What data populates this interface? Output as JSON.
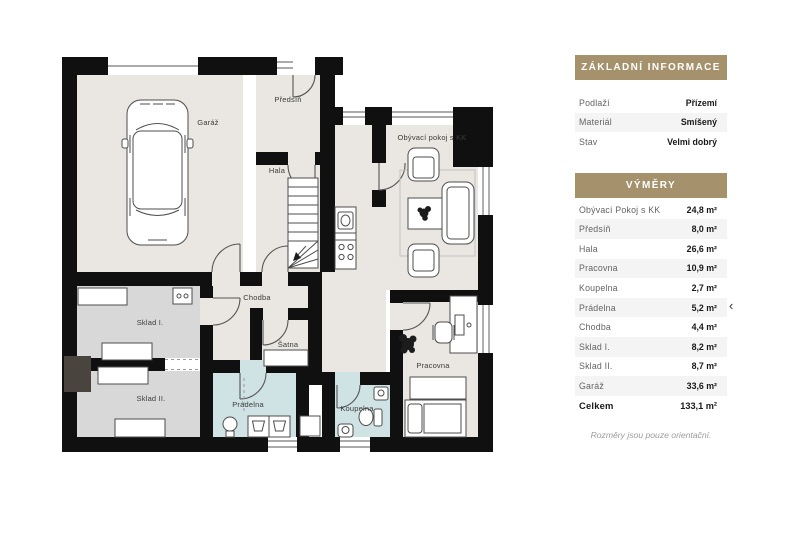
{
  "panel": {
    "basic_info": {
      "title": "ZÁKLADNÍ INFORMACE",
      "rows": [
        {
          "label": "Podlaží",
          "value": "Přízemí"
        },
        {
          "label": "Materiál",
          "value": "Smíšený"
        },
        {
          "label": "Stav",
          "value": "Velmi dobrý"
        }
      ]
    },
    "dimensions": {
      "title": "VÝMĚRY",
      "rows": [
        {
          "label": "Obývací Pokoj s KK",
          "value": "24,8 m²"
        },
        {
          "label": "Předsíň",
          "value": "8,0 m²"
        },
        {
          "label": "Hala",
          "value": "26,6 m²"
        },
        {
          "label": "Pracovna",
          "value": "10,9 m²"
        },
        {
          "label": "Koupelna",
          "value": "2,7 m²"
        },
        {
          "label": "Prádelna",
          "value": "5,2 m²"
        },
        {
          "label": "Chodba",
          "value": "4,4 m²"
        },
        {
          "label": "Sklad I.",
          "value": "8,2 m²"
        },
        {
          "label": "Sklad II.",
          "value": "8,7 m²"
        },
        {
          "label": "Garáž",
          "value": "33,6 m²"
        },
        {
          "label": "Celkem",
          "value": "133,1 m²"
        }
      ],
      "footnote": "Rozměry jsou pouze orientační."
    }
  },
  "plan": {
    "rooms": [
      {
        "label": "Garáž"
      },
      {
        "label": "Předsíň"
      },
      {
        "label": "Hala"
      },
      {
        "label": "Obývací pokoj s KK"
      },
      {
        "label": "Chodba"
      },
      {
        "label": "Sklad I."
      },
      {
        "label": "Sklad II."
      },
      {
        "label": "Šatna"
      },
      {
        "label": "Prádelna"
      },
      {
        "label": "Koupelna"
      },
      {
        "label": "Pracovna"
      }
    ]
  },
  "nav": {
    "prev_icon": "‹"
  },
  "colors": {
    "accent": "#a5926d",
    "wall": "#101010",
    "floor_beige": "#eae6e1",
    "floor_gray": "#d8d8d8",
    "floor_blue": "#cfe2e4",
    "row_stripe": "#f4f4f4"
  }
}
